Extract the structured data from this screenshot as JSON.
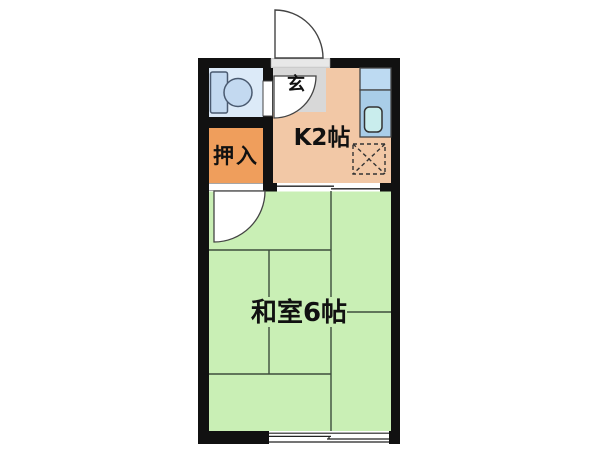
{
  "floor_plan": {
    "type": "apartment-floor-plan",
    "labels": {
      "entrance": "玄",
      "kitchen": "K2帖",
      "closet": "押入",
      "main_room": "和室6帖"
    },
    "colors": {
      "background": "#ffffff",
      "wall": "#111111",
      "kitchen_floor": "#f2c8a6",
      "main_room_floor": "#c9efb5",
      "closet_fill": "#ef9e5c",
      "entrance_floor": "#d8d8d8",
      "toilet_room_fill": "#dceaf8",
      "fixture_blue": "#c3d9f0",
      "counter_upper": "#bddaf2",
      "counter_lower": "#a9cde8",
      "sink_fill": "#c9eded",
      "tatami_line": "#3d4d3d",
      "door_outline": "#444444",
      "threshold_fill": "#e8e8e8"
    },
    "icons": {
      "toilet": "toilet-icon",
      "kitchen_sink": "kitchen-sink-icon",
      "stove_space": "hatched-square-icon",
      "entrance_door": "quarter-circle-door-swing",
      "toilet_door": "quarter-circle-door-swing",
      "closet_door": "quarter-circle-door-swing",
      "sliding_door": "offset-double-line",
      "window": "offset-double-line"
    }
  }
}
